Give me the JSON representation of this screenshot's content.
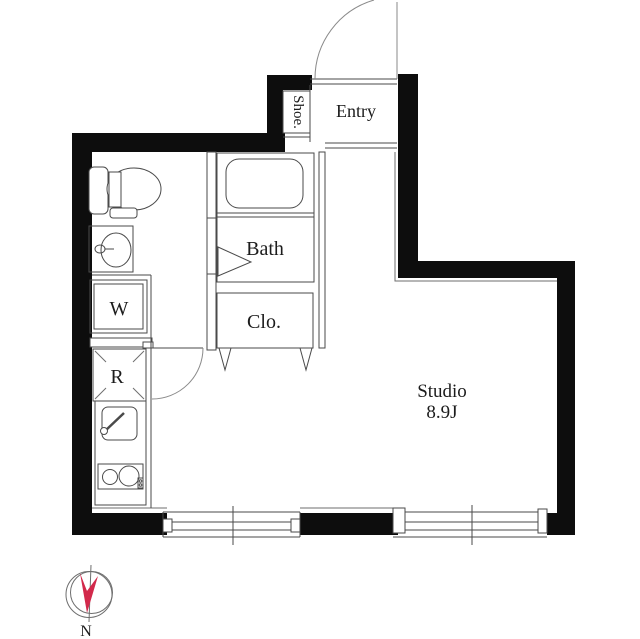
{
  "labels": {
    "entry": "Entry",
    "shoe": "Shoe.",
    "bath": "Bath",
    "closet": "Clo.",
    "washer": "W",
    "refrigerator": "R",
    "studio_name": "Studio",
    "studio_size": "8.9J",
    "compass_north": "N"
  },
  "colors": {
    "wall": "#0d0d0d",
    "line": "#4a4a4a",
    "compass_accent": "#d2294b"
  }
}
